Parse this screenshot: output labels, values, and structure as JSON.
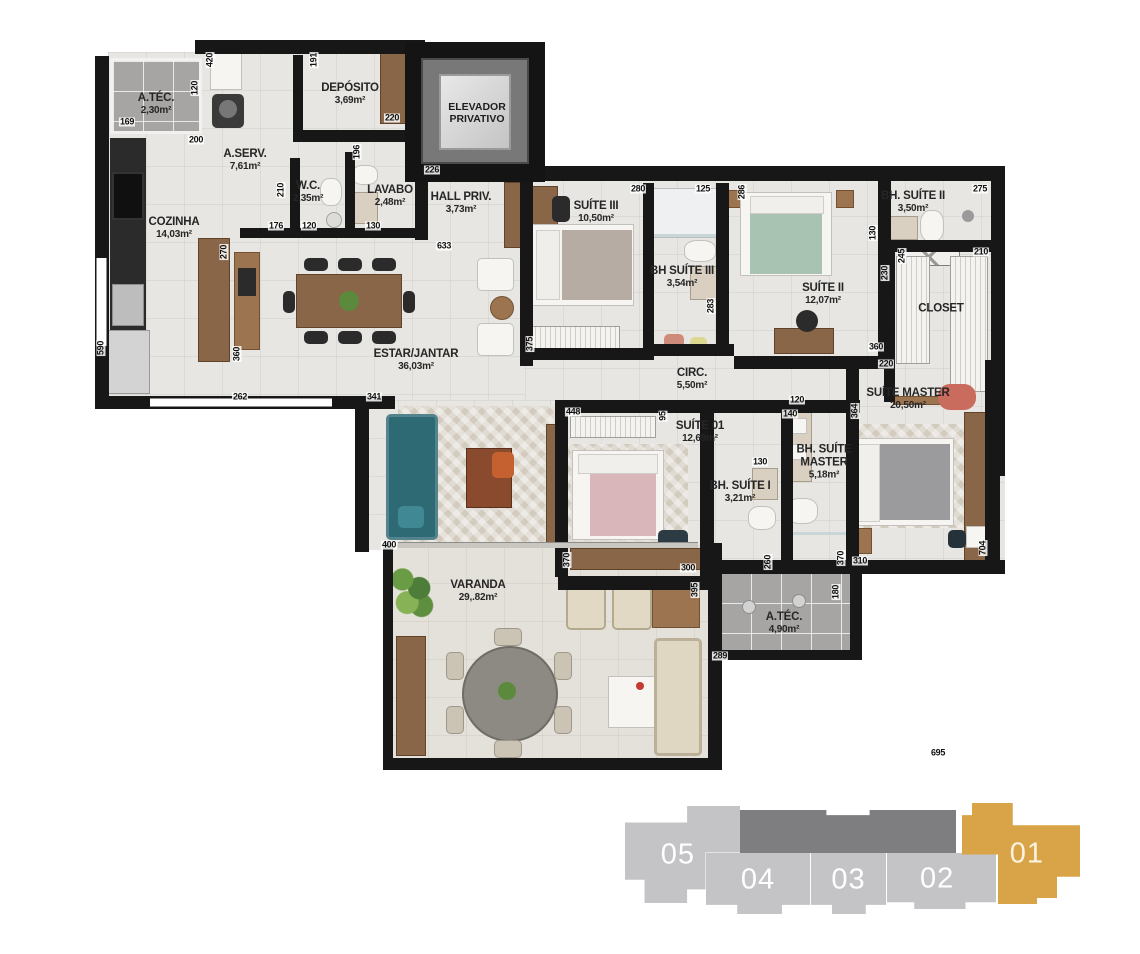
{
  "rooms": {
    "atec1": {
      "name": "A.TÉC.",
      "area": "2,30m²"
    },
    "deposito": {
      "name": "DEPÓSITO",
      "area": "3,69m²"
    },
    "elevador": {
      "name": "ELEVADOR PRIVATIVO",
      "area": ""
    },
    "aserv": {
      "name": "A.SERV.",
      "area": "7,61m²"
    },
    "wc": {
      "name": "W.C.",
      "area": "2,35m²"
    },
    "lavabo": {
      "name": "LAVABO",
      "area": "2,48m²"
    },
    "hall": {
      "name": "HALL PRIV.",
      "area": "3,73m²"
    },
    "cozinha": {
      "name": "COZINHA",
      "area": "14,03m²"
    },
    "estar": {
      "name": "ESTAR/JANTAR",
      "area": "36,03m²"
    },
    "suite3": {
      "name": "SUÍTE III",
      "area": "10,50m²"
    },
    "bhsuite3": {
      "name": "BH SUÍTE III",
      "area": "3,54m²"
    },
    "suite2": {
      "name": "SUÍTE II",
      "area": "12,07m²"
    },
    "bhsuite2": {
      "name": "BH. SUÍTE II",
      "area": "3,50m²"
    },
    "closet": {
      "name": "CLOSET",
      "area": ""
    },
    "circ": {
      "name": "CIRC.",
      "area": "5,50m²"
    },
    "suitemaster": {
      "name": "SUÍTE MASTER",
      "area": "20,50m²"
    },
    "suite1": {
      "name": "SUÍTE 01",
      "area": "12,69m²"
    },
    "bhsuite1": {
      "name": "BH. SUÍTE I",
      "area": "3,21m²"
    },
    "bhmaster": {
      "name": "BH. SUÍTE MASTER",
      "area": "5,18m²"
    },
    "varanda": {
      "name": "VARANDA",
      "area": "29,.82m²"
    },
    "atec2": {
      "name": "A.TÉC.",
      "area": "4,90m²"
    }
  },
  "dims": [
    {
      "v": "169",
      "x": 127,
      "y": 122
    },
    {
      "v": "200",
      "x": 196,
      "y": 140
    },
    {
      "v": "220",
      "x": 392,
      "y": 118
    },
    {
      "v": "226",
      "x": 432,
      "y": 170
    },
    {
      "v": "176",
      "x": 276,
      "y": 226
    },
    {
      "v": "120",
      "x": 309,
      "y": 226
    },
    {
      "v": "130",
      "x": 373,
      "y": 226
    },
    {
      "v": "633",
      "x": 444,
      "y": 246
    },
    {
      "v": "262",
      "x": 240,
      "y": 397
    },
    {
      "v": "341",
      "x": 374,
      "y": 397
    },
    {
      "v": "400",
      "x": 389,
      "y": 545
    },
    {
      "v": "280",
      "x": 638,
      "y": 189
    },
    {
      "v": "125",
      "x": 703,
      "y": 189
    },
    {
      "v": "275",
      "x": 980,
      "y": 189
    },
    {
      "v": "210",
      "x": 981,
      "y": 252
    },
    {
      "v": "360",
      "x": 876,
      "y": 347
    },
    {
      "v": "220",
      "x": 886,
      "y": 364
    },
    {
      "v": "120",
      "x": 797,
      "y": 400
    },
    {
      "v": "140",
      "x": 790,
      "y": 414
    },
    {
      "v": "448",
      "x": 573,
      "y": 412
    },
    {
      "v": "130",
      "x": 760,
      "y": 462
    },
    {
      "v": "300",
      "x": 688,
      "y": 568
    },
    {
      "v": "310",
      "x": 860,
      "y": 561
    },
    {
      "v": "289",
      "x": 720,
      "y": 656
    },
    {
      "v": "695",
      "x": 938,
      "y": 753
    },
    {
      "v": "420",
      "x": 210,
      "y": 60,
      "vert": 1
    },
    {
      "v": "120",
      "x": 195,
      "y": 88,
      "vert": 1
    },
    {
      "v": "191",
      "x": 314,
      "y": 60,
      "vert": 1
    },
    {
      "v": "196",
      "x": 357,
      "y": 152,
      "vert": 1
    },
    {
      "v": "210",
      "x": 281,
      "y": 190,
      "vert": 1
    },
    {
      "v": "270",
      "x": 224,
      "y": 252,
      "vert": 1
    },
    {
      "v": "590",
      "x": 101,
      "y": 348,
      "vert": 1
    },
    {
      "v": "360",
      "x": 237,
      "y": 354,
      "vert": 1
    },
    {
      "v": "286",
      "x": 742,
      "y": 192,
      "vert": 1
    },
    {
      "v": "375",
      "x": 530,
      "y": 344,
      "vert": 1
    },
    {
      "v": "283",
      "x": 711,
      "y": 306,
      "vert": 1
    },
    {
      "v": "130",
      "x": 873,
      "y": 233,
      "vert": 1
    },
    {
      "v": "245",
      "x": 902,
      "y": 256,
      "vert": 1
    },
    {
      "v": "230",
      "x": 885,
      "y": 273,
      "vert": 1
    },
    {
      "v": "95",
      "x": 663,
      "y": 416,
      "vert": 1
    },
    {
      "v": "364",
      "x": 855,
      "y": 411,
      "vert": 1
    },
    {
      "v": "370",
      "x": 567,
      "y": 560,
      "vert": 1
    },
    {
      "v": "395",
      "x": 695,
      "y": 590,
      "vert": 1
    },
    {
      "v": "260",
      "x": 768,
      "y": 562,
      "vert": 1
    },
    {
      "v": "370",
      "x": 841,
      "y": 558,
      "vert": 1
    },
    {
      "v": "180",
      "x": 836,
      "y": 592,
      "vert": 1
    },
    {
      "v": "704",
      "x": 983,
      "y": 548,
      "vert": 1
    }
  ],
  "key_plan": {
    "selected": "01",
    "units": [
      {
        "label": "05"
      },
      {
        "label": "04"
      },
      {
        "label": "03"
      },
      {
        "label": "02"
      },
      {
        "label": "01"
      }
    ]
  },
  "colors": {
    "accent_gold": "#D8A447",
    "unit_gray": "#C4C4C6",
    "core_gray": "#7E7E80",
    "wall": "#171717",
    "floor": "#E7E6E2",
    "tech_floor": "#A6A5A3"
  }
}
